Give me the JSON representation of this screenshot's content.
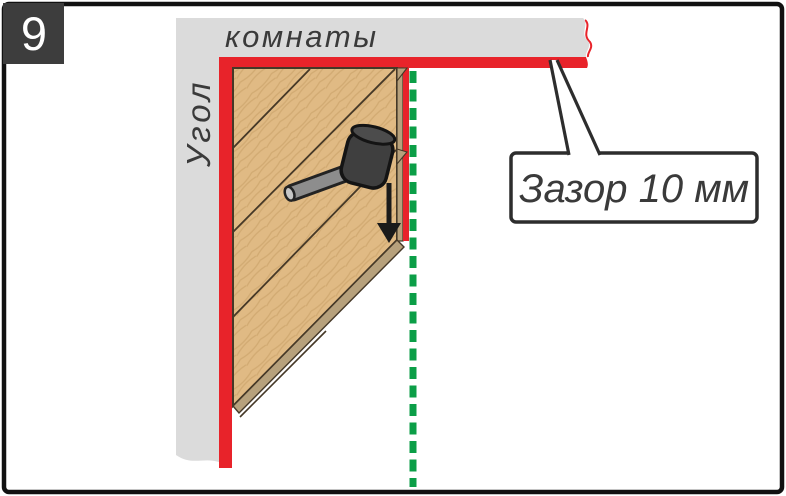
{
  "step_badge": {
    "number": "9"
  },
  "walls": {
    "horizontal_label": "комнаты",
    "vertical_label": "Угол"
  },
  "callout": {
    "text": "Зазор 10 мм"
  },
  "icons": {
    "mallet": "rubber-mallet-icon",
    "arrow": "tap-down-arrow-icon",
    "guide_line": "green-dashed-guide-line",
    "gap_spacer": "red-expansion-gap-strip"
  },
  "colors": {
    "frame": "#111111",
    "badge_bg": "#3d3d3d",
    "badge_text": "#ffffff",
    "wall": "#dbdbdb",
    "gap_red": "#e8232a",
    "wood": "#e0ba84",
    "wood_grain": "#cfa76f",
    "wood_edge": "#b7a17c",
    "wood_outline": "#453827",
    "guide_green": "#0b9e47",
    "mallet_head": "#3f3f3f",
    "mallet_head_top": "#4c4c4c",
    "mallet_handle": "#8d8d8d",
    "arrow_black": "#1a1a1a",
    "callout_border": "#2d2d2d",
    "text": "#3a3a3a"
  }
}
